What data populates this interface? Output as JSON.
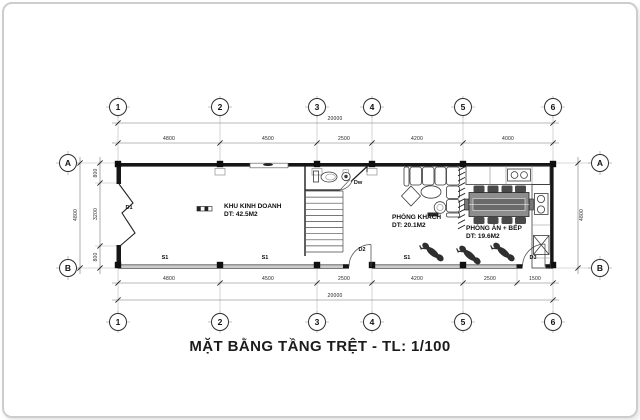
{
  "title": "MẶT BẰNG TẦNG TRỆT - TL: 1/100",
  "grid": {
    "columns": [
      "1",
      "2",
      "3",
      "4",
      "5",
      "6"
    ],
    "rows": [
      "A",
      "B"
    ]
  },
  "rooms": [
    {
      "name": "KHU KINH DOANH",
      "area": "DT: 42.5M2"
    },
    {
      "name": "PHÒNG KHÁCH",
      "area": "DT: 20.1M2"
    },
    {
      "name": "PHÒNG ĂN + BẾP",
      "area": "DT: 19.6M2"
    }
  ],
  "openings": {
    "folding_door": "D1",
    "wc_door": "Dw",
    "rear_door": "D2",
    "side_door": "D3",
    "window": "S1"
  },
  "dimensions": {
    "top_total": "20000",
    "top_segments": [
      "4800",
      "4500",
      "2500",
      "4200",
      "4000"
    ],
    "bottom_total": "20000",
    "bottom_segments": [
      "4800",
      "4500",
      "2500",
      "4200",
      "2500",
      "1500"
    ],
    "left_total": "4800",
    "left_segments": [
      "800",
      "3200",
      "800"
    ],
    "right_total": "4800"
  },
  "colors": {
    "wall": "#161616",
    "line": "#3a3a3a",
    "dim_line": "#777777",
    "frame": "#cdcdcd",
    "background": "#ffffff"
  }
}
